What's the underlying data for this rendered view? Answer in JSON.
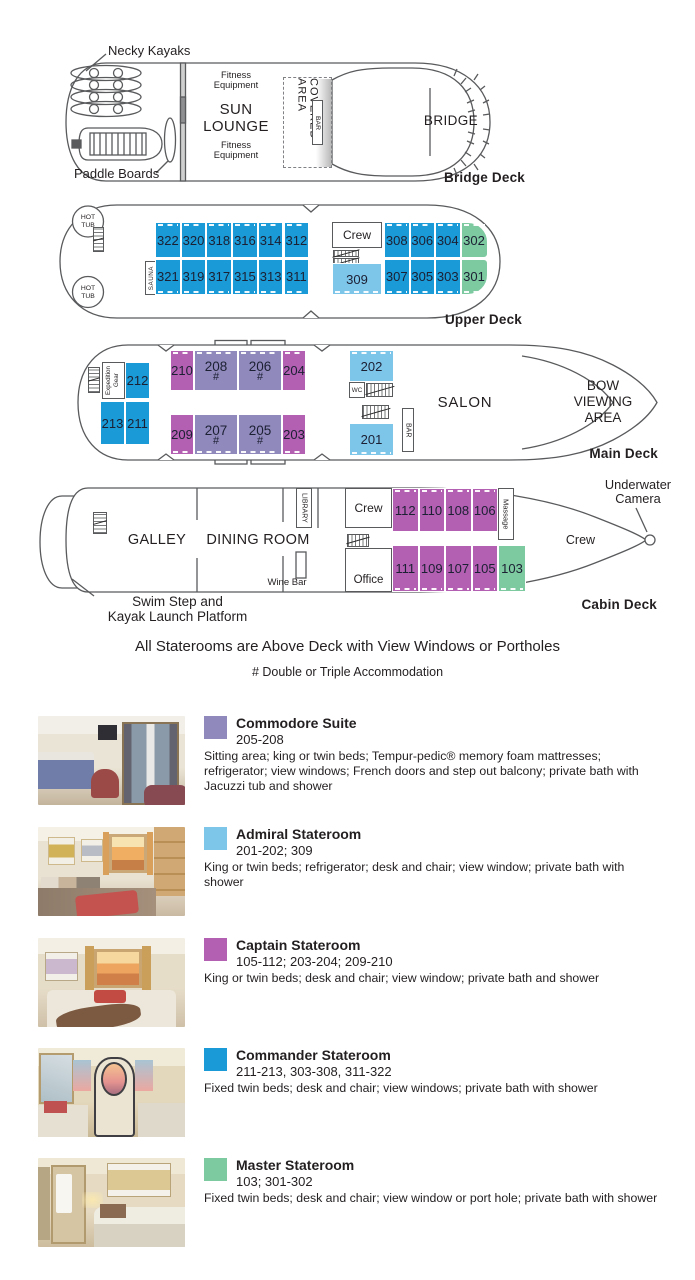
{
  "colors": {
    "commodore": "#9089BC",
    "admiral": "#7EC5EA",
    "captain": "#B35FB2",
    "commander": "#1A9AD6",
    "master": "#7DC9A0"
  },
  "decks": {
    "bridge": {
      "label": "Bridge Deck",
      "necky_kayaks": "Necky Kayaks",
      "paddle_boards": "Paddle Boards",
      "fitness_top": "Fitness Equipment",
      "fitness_bottom": "Fitness Equipment",
      "sun_lounge": "SUN LOUNGE",
      "covered_area": "COVERED AREA",
      "bar": "BAR",
      "bridge_room": "BRIDGE"
    },
    "upper": {
      "label": "Upper Deck",
      "hot_tub": "HOT TUB",
      "sauna": "SAUNA",
      "crew": "Crew",
      "top": [
        "322",
        "320",
        "318",
        "316",
        "314",
        "312",
        "308",
        "306",
        "304",
        "302"
      ],
      "bottom": [
        "321",
        "319",
        "317",
        "315",
        "313",
        "311",
        "309",
        "307",
        "305",
        "303",
        "301"
      ]
    },
    "main": {
      "label": "Main Deck",
      "expedition_gear": "Expedition Gear",
      "wc": "WC",
      "bar": "BAR",
      "salon": "SALON",
      "bow_viewing": "BOW VIEWING AREA",
      "stern": [
        "212",
        "213",
        "211"
      ],
      "top": [
        {
          "n": "210",
          "m": ""
        },
        {
          "n": "208",
          "m": "#"
        },
        {
          "n": "206",
          "m": "#"
        },
        {
          "n": "204",
          "m": ""
        }
      ],
      "bottom": [
        {
          "n": "209",
          "m": ""
        },
        {
          "n": "207",
          "m": "#"
        },
        {
          "n": "205",
          "m": "#"
        },
        {
          "n": "203",
          "m": ""
        }
      ],
      "mid_top": "202",
      "mid_bottom": "201"
    },
    "cabin": {
      "label": "Cabin Deck",
      "galley": "GALLEY",
      "dining_room": "DINING ROOM",
      "library": "LIBRARY",
      "wine_bar": "Wine Bar",
      "crew_aft": "Crew",
      "crew_fwd": "Crew",
      "office": "Office",
      "massage": "Massage",
      "underwater_camera": "Underwater Camera",
      "swim_step_line1": "Swim Step and",
      "swim_step_line2": "Kayak Launch Platform",
      "top": [
        "112",
        "110",
        "108",
        "106"
      ],
      "bottom": [
        "111",
        "109",
        "107",
        "105",
        "103"
      ]
    }
  },
  "notes": {
    "line1": "All Staterooms are Above Deck with View Windows or Portholes",
    "line2": "# Double or Triple Accommodation"
  },
  "legend": [
    {
      "name": "Commodore Suite",
      "rooms": "205-208",
      "description": "Sitting area; king or twin beds; Tempur-pedic® memory foam mattresses; refrigerator; view windows; French doors and step out balcony; private bath with Jacuzzi tub and shower",
      "color": "#9089BC"
    },
    {
      "name": "Admiral Stateroom",
      "rooms": "201-202; 309",
      "description": "King or twin beds; refrigerator; desk and chair; view window; private bath with shower",
      "color": "#7EC5EA"
    },
    {
      "name": "Captain Stateroom",
      "rooms": "105-112; 203-204; 209-210",
      "description": "King or twin beds; desk and chair; view window; private bath and shower",
      "color": "#B35FB2"
    },
    {
      "name": "Commander Stateroom",
      "rooms": "211-213, 303-308, 311-322",
      "description": "Fixed twin beds; desk and chair; view windows; private bath with shower",
      "color": "#1A9AD6"
    },
    {
      "name": "Master Stateroom",
      "rooms": "103; 301-302",
      "description": "Fixed twin beds; desk and chair; view window or port hole; private bath with shower",
      "color": "#7DC9A0"
    }
  ]
}
